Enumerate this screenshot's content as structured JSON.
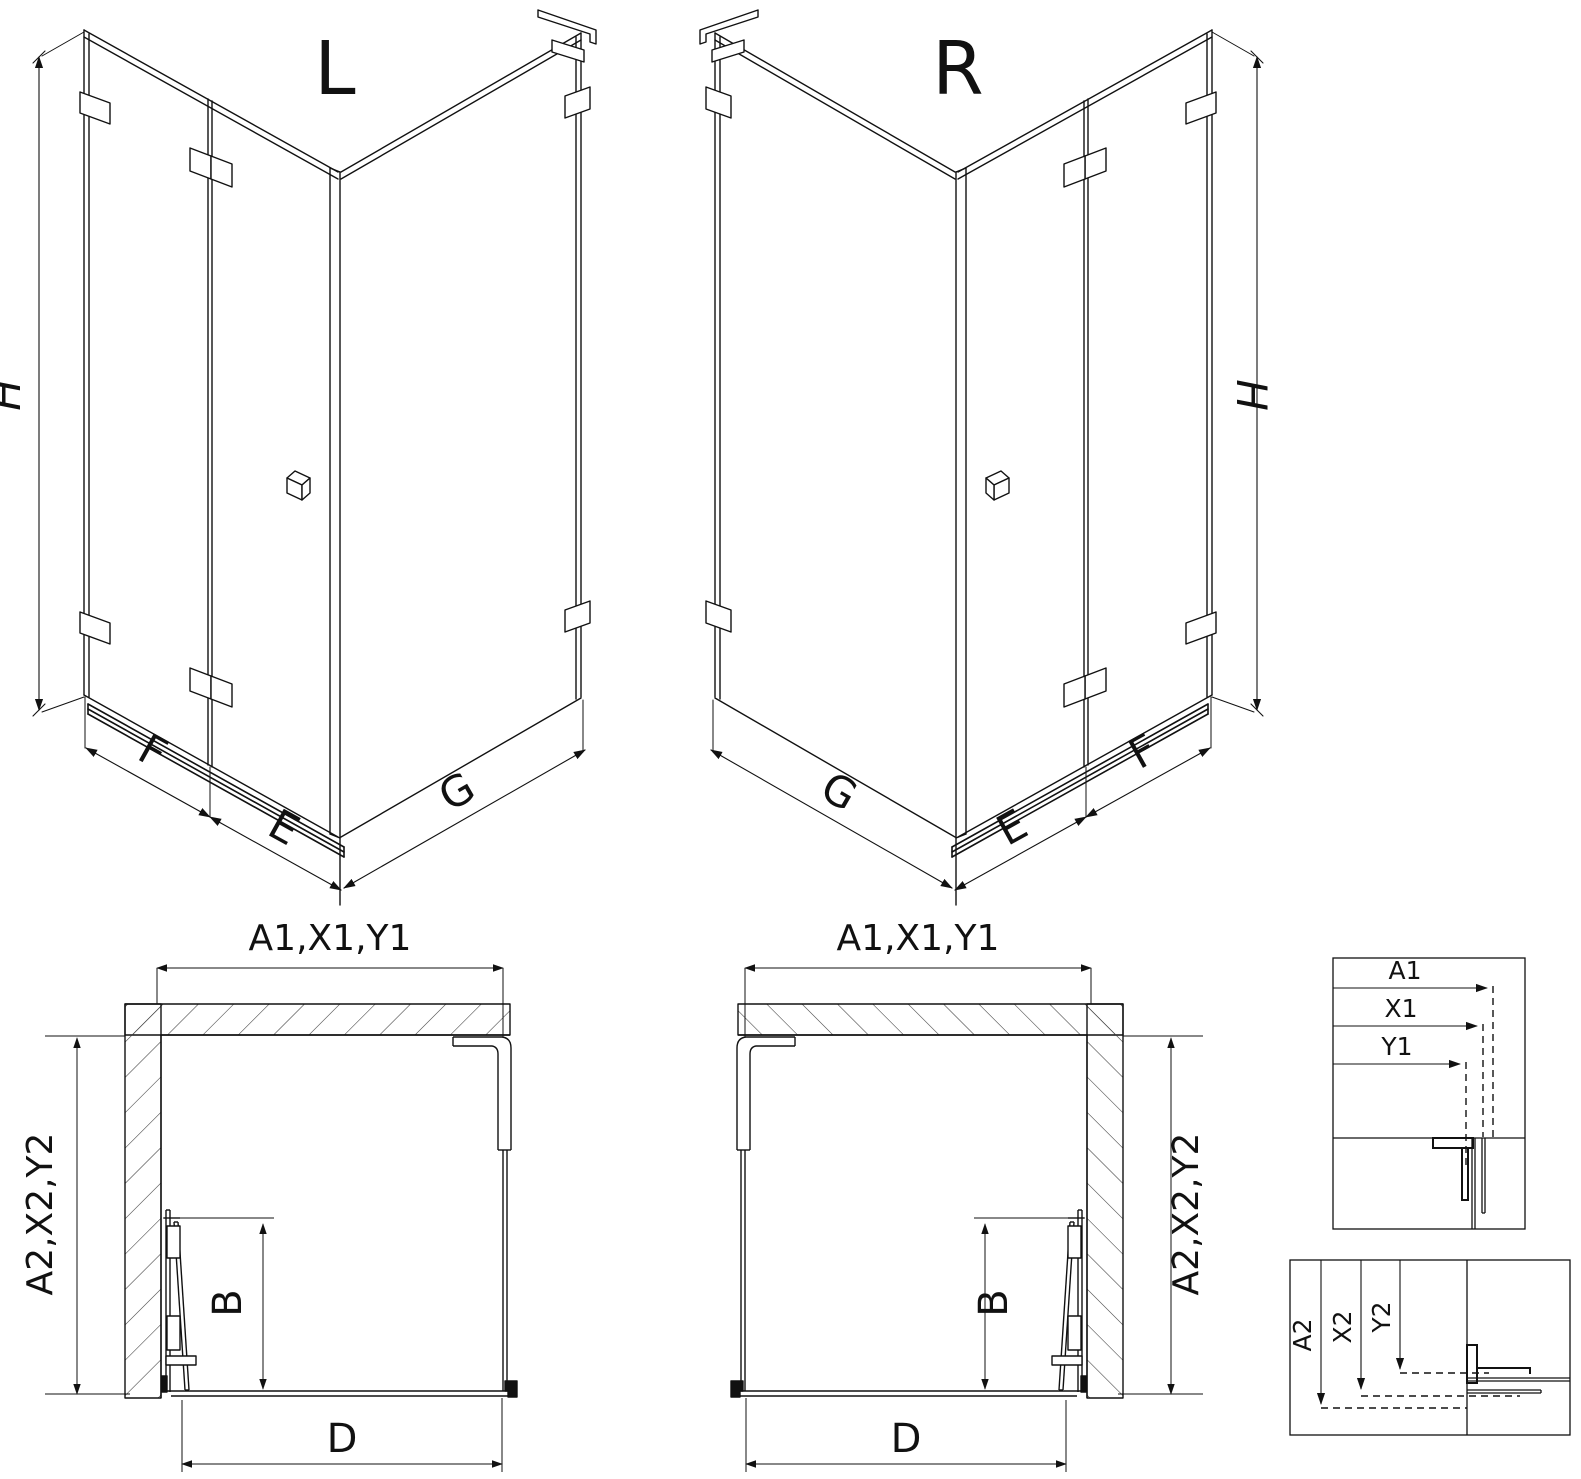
{
  "diagram": {
    "iso_left": {
      "title": "L",
      "height": "H",
      "door_panel": "F",
      "near_panel": "E",
      "side_panel": "G"
    },
    "iso_right": {
      "title": "R",
      "height": "H",
      "door_panel": "F",
      "near_panel": "E",
      "side_panel": "G"
    },
    "plan_left": {
      "width_top": "A1,X1,Y1",
      "depth_side": "A2,X2,Y2",
      "door_opening": "B",
      "entry_width": "D"
    },
    "plan_middle": {
      "width_top": "A1,X1,Y1",
      "depth_side": "A2,X2,Y2",
      "door_opening": "B",
      "entry_width": "D"
    },
    "detail_width": {
      "a1": "A1",
      "x1": "X1",
      "y1": "Y1"
    },
    "detail_height": {
      "a2": "A2",
      "x2": "X2",
      "y2": "Y2"
    }
  },
  "colors": {
    "line": "#111111",
    "hatch": "#3a3a3a",
    "background": "#ffffff"
  }
}
